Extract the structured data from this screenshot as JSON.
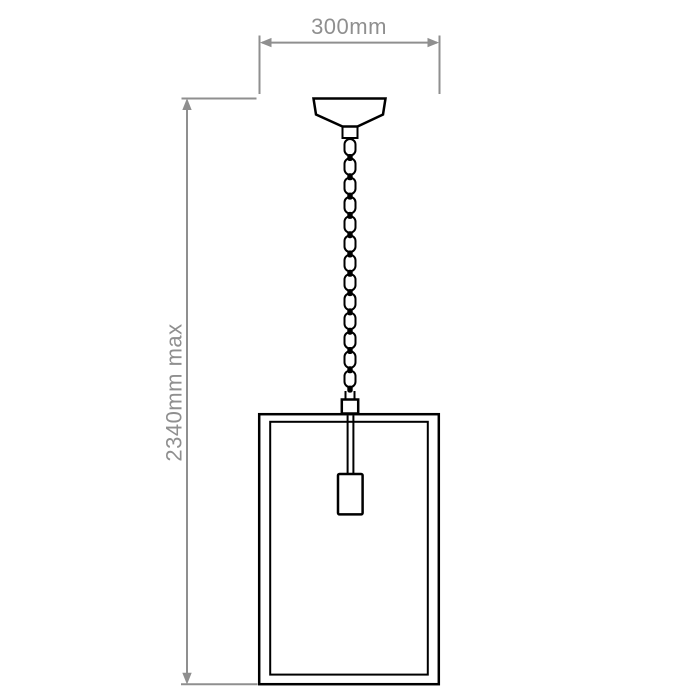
{
  "labels": {
    "width": "300mm",
    "height_max": "2340mm max"
  },
  "colors": {
    "line": "#000000",
    "dimension": "#8f8f8f",
    "background": "#ffffff"
  }
}
